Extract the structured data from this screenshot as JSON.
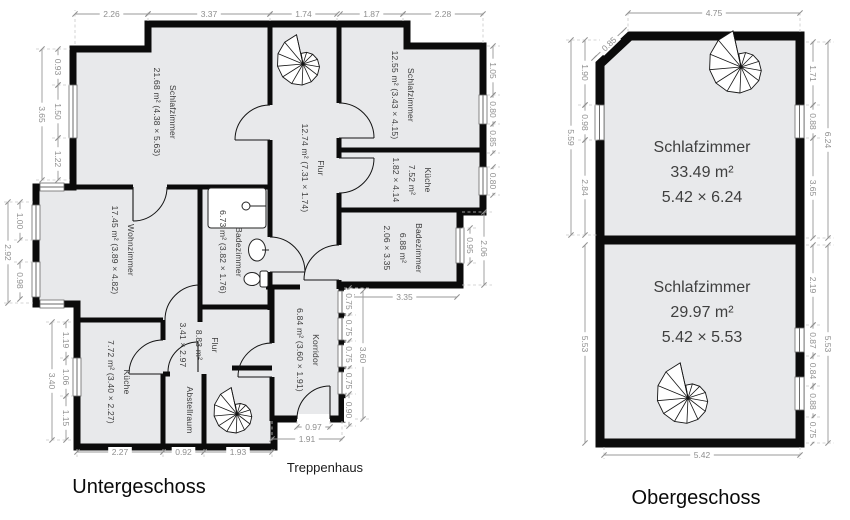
{
  "colors": {
    "wall": "#0b0b0b",
    "room_fill": "#e8e9eb",
    "dim_text": "#8e8e8e"
  },
  "floors": {
    "unter": {
      "title": "Untergeschoss",
      "stair_label": "Treppenhaus",
      "rooms": {
        "schlafzimmer_big": {
          "lines": [
            "Schlafzimmer",
            "21.68 m² (4.38 × 5.63)"
          ]
        },
        "schlafzimmer_small": {
          "lines": [
            "Schlafzimmer",
            "12.55 m² (3.43 × 4.15)"
          ]
        },
        "kueche_right": {
          "lines": [
            "Küche",
            "7.52 m²",
            "1.82 × 4.14"
          ]
        },
        "flur_main": {
          "lines": [
            "Flur",
            "12.74 m² (7.31 × 1.74)"
          ]
        },
        "wohnzimmer": {
          "lines": [
            "Wohnzimmer",
            "17.45 m² (3.89 × 4.82)"
          ]
        },
        "badezimmer_left": {
          "lines": [
            "Badezimmer",
            "6.73 m² (3.82 × 1.76)"
          ]
        },
        "badezimmer_right": {
          "lines": [
            "Badezimmer",
            "6.88 m²",
            "2.06 × 3.35"
          ]
        },
        "korridor": {
          "lines": [
            "Korridor",
            "6.84 m² (3.60 × 1.91)"
          ]
        },
        "flur_small": {
          "lines": [
            "Flur",
            "8.83 m²",
            "3.41 × 2.97"
          ]
        },
        "kueche_left": {
          "lines": [
            "Küche",
            "7.72 m² (3.40 × 2.27)"
          ]
        },
        "abstellraum": {
          "lines": [
            "Abstellraum"
          ]
        }
      },
      "dims": {
        "top": [
          "2.26",
          "3.37",
          "1.74",
          "1.87",
          "2.28"
        ],
        "left_upper": [
          "0.93",
          "1.50",
          "1.22"
        ],
        "left_upper_total": "3.65",
        "left_bay": [
          "1.00",
          "0.98"
        ],
        "left_bay_total": "2.92",
        "left_lower": [
          "1.19",
          "1.06",
          "1.15"
        ],
        "left_lower_total": "3.40",
        "right_upper": [
          "1.05",
          "0.80",
          "0.85"
        ],
        "right_kueche": "0.80",
        "right_bad": [
          "0.95",
          "2.06"
        ],
        "bad_width": "3.35",
        "korridor_right": [
          "0.75",
          "0.75",
          "0.75",
          "0.75",
          "0.90"
        ],
        "korridor_total": "3.60",
        "bottom": [
          "2.27",
          "0.92",
          "1.93"
        ],
        "korridor_door": "0.97",
        "korridor_width": "1.91"
      }
    },
    "ober": {
      "title": "Obergeschoss",
      "rooms": {
        "schlafzimmer_1": {
          "lines": [
            "Schlafzimmer",
            "33.49 m²",
            "5.42 × 6.24"
          ]
        },
        "schlafzimmer_2": {
          "lines": [
            "Schlafzimmer",
            "29.97 m²",
            "5.42 × 5.53"
          ]
        }
      },
      "dims": {
        "top": "4.75",
        "chamfer": "0.85",
        "left": [
          "1.90",
          "0.98",
          "2.84"
        ],
        "left_total": "5.59",
        "right_upper": [
          "1.71",
          "0.88",
          "3.65"
        ],
        "right_upper_total": "6.24",
        "right_lower": [
          "2.19",
          "0.87",
          "0.84",
          "0.88",
          "0.75"
        ],
        "right_lower_total": "5.53",
        "left_lower": "5.53",
        "bottom": "5.42"
      }
    }
  }
}
